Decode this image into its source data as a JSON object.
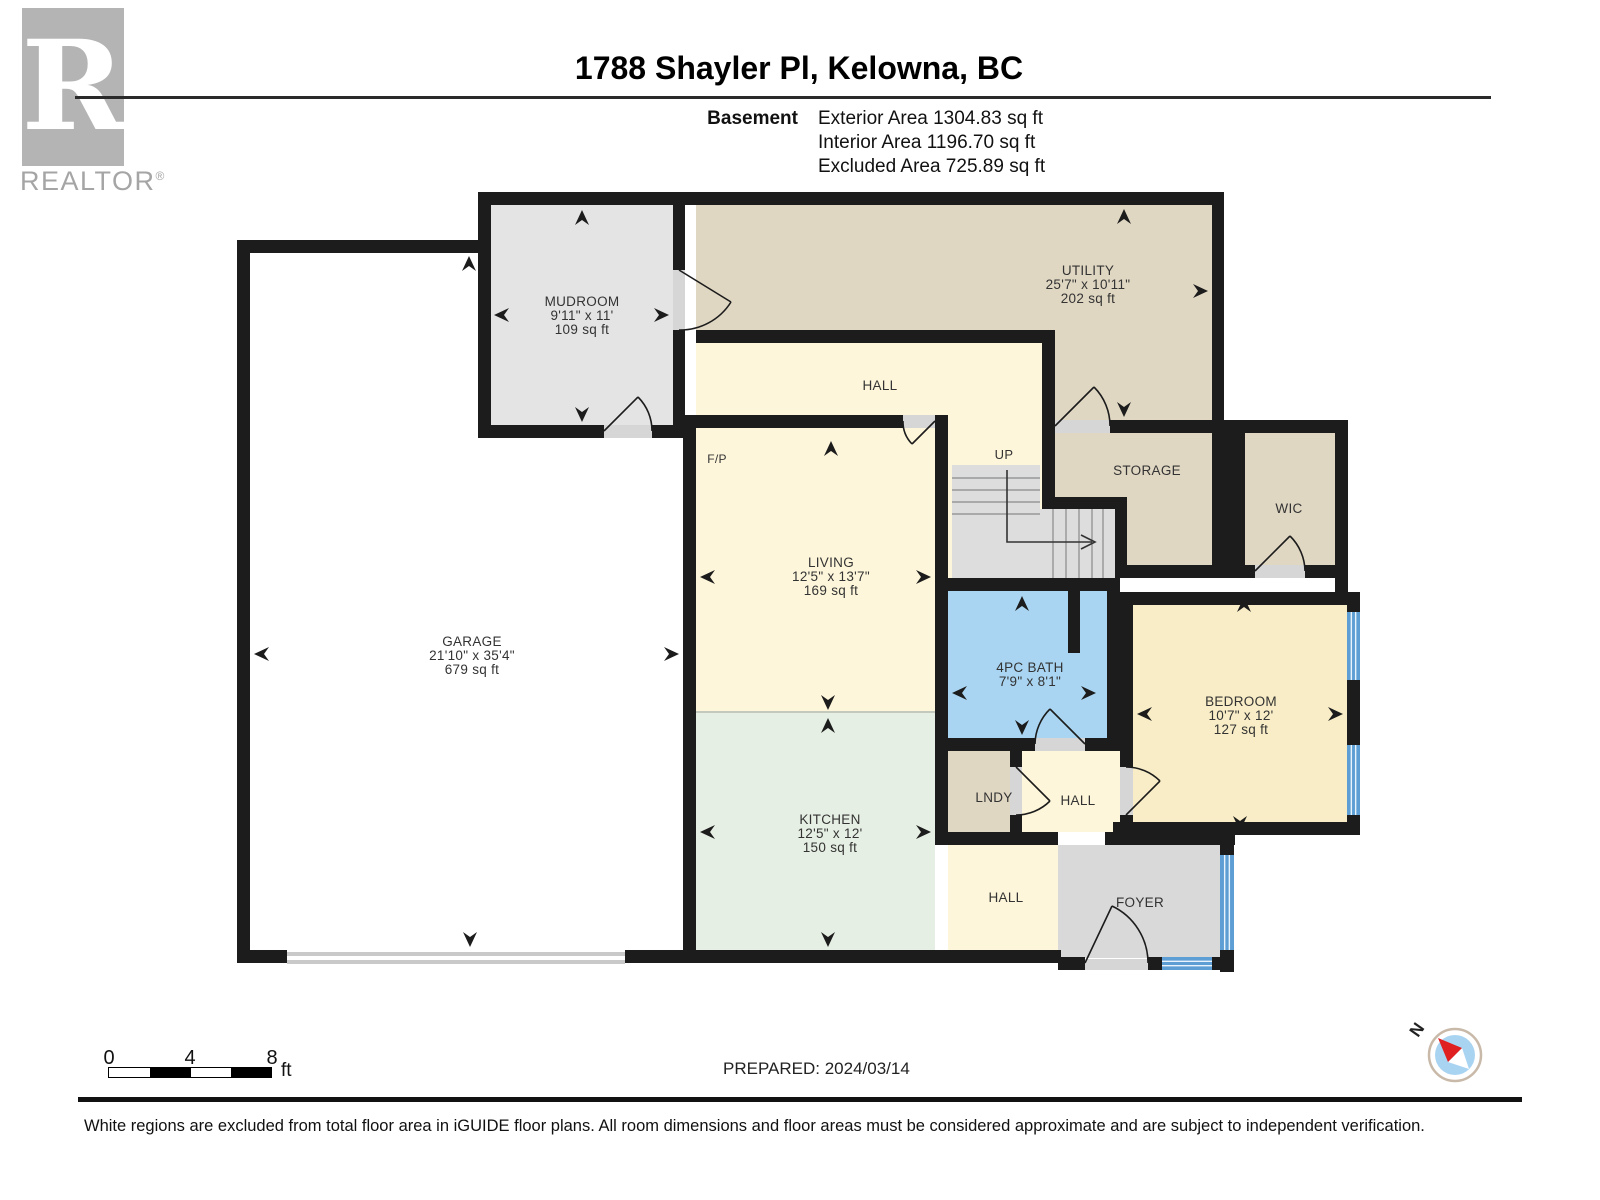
{
  "header": {
    "title": "1788 Shayler Pl, Kelowna, BC",
    "logo_r": "R",
    "logo_text": "REALTOR",
    "logo_reg": "®",
    "floor_label": "Basement",
    "exterior_area": "Exterior Area 1304.83 sq ft",
    "interior_area": "Interior Area 1196.70 sq ft",
    "excluded_area": "Excluded Area 725.89 sq ft"
  },
  "rooms": {
    "mudroom": {
      "name": "MUDROOM",
      "dims": "9'11\" x 11'",
      "area": "109 sq ft"
    },
    "utility": {
      "name": "UTILITY",
      "dims": "25'7\" x 10'11\"",
      "area": "202 sq ft"
    },
    "hall_upper": {
      "name": "HALL"
    },
    "fireplace": {
      "name": "F/P"
    },
    "stairs": {
      "name": "UP"
    },
    "storage": {
      "name": "STORAGE"
    },
    "wic": {
      "name": "WIC"
    },
    "living": {
      "name": "LIVING",
      "dims": "12'5\" x 13'7\"",
      "area": "169 sq ft"
    },
    "garage": {
      "name": "GARAGE",
      "dims": "21'10\" x 35'4\"",
      "area": "679 sq ft"
    },
    "bath": {
      "name": "4PC BATH",
      "dims": "7'9\" x 8'1\""
    },
    "bedroom": {
      "name": "BEDROOM",
      "dims": "10'7\" x 12'",
      "area": "127 sq ft"
    },
    "kitchen": {
      "name": "KITCHEN",
      "dims": "12'5\" x 12'",
      "area": "150 sq ft"
    },
    "laundry": {
      "name": "LNDY"
    },
    "hall_mid": {
      "name": "HALL"
    },
    "hall_lower": {
      "name": "HALL"
    },
    "foyer": {
      "name": "FOYER"
    }
  },
  "footer": {
    "scale_0": "0",
    "scale_4": "4",
    "scale_8": "8",
    "scale_unit": "ft",
    "prepared": "PREPARED: 2024/03/14",
    "compass_n": "N",
    "disclaimer": "White regions are excluded from total floor area in iGUIDE floor plans. All room dimensions and floor areas must be considered approximate and are subject to independent verification."
  },
  "colors": {
    "wall": "#1c1c1c",
    "cream": "#fdf6da",
    "tan": "#e0d7c3",
    "mudroom_gray": "#e4e4e4",
    "stair_gray": "#dddddd",
    "mint": "#e6efe3",
    "bath_blue": "#a9d5f2",
    "bedroom_yellow": "#f8edc6",
    "foyer_gray": "#d9d9d9",
    "garage_white": "#ffffff",
    "window_blue": "#5d9fd4",
    "door_sill": "#d6d6d6",
    "compass_red": "#e02020",
    "compass_blue": "#a9d4f1",
    "logo_gray": "#b4b4b4"
  }
}
